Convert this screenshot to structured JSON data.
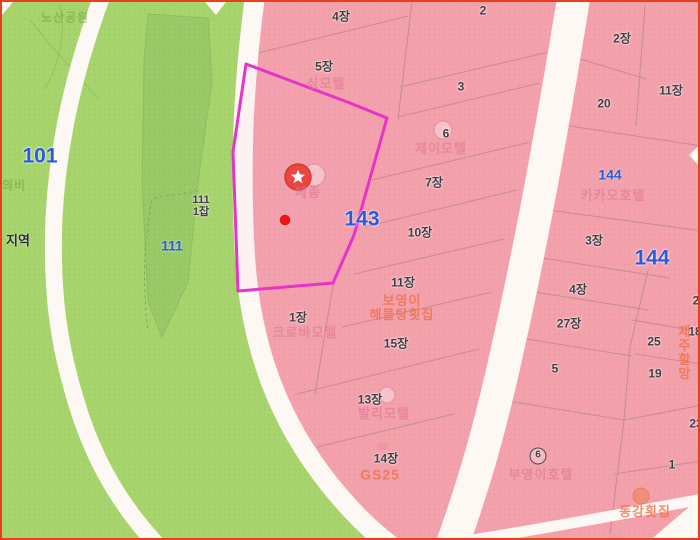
{
  "map": {
    "description": "Korean cadastral parcel map with highlighted lot",
    "colors": {
      "parcel_pink": "#f3a2ac",
      "forest_green": "#a8d46e",
      "forest_dark_green": "#99c966",
      "road_white": "#fdf8f4",
      "parcel_line": "#bf8a92",
      "highlight_magenta": "#e633c8",
      "zone_blue": "#2b59d8",
      "poi_orange": "#ee6e4a",
      "business_pink": "#df7392",
      "marker_red": "#e8463e",
      "frame_red": "#e8401c"
    },
    "labels": {
      "zones": [
        {
          "text": "101"
        },
        {
          "text": "111"
        },
        {
          "text": "143"
        },
        {
          "text": "144"
        },
        {
          "text": "144"
        }
      ],
      "parcels": [
        {
          "text": "4장"
        },
        {
          "text": "2"
        },
        {
          "text": "5장"
        },
        {
          "text": "3"
        },
        {
          "text": "6"
        },
        {
          "text": "2장"
        },
        {
          "text": "20"
        },
        {
          "text": "11장"
        },
        {
          "text": "7장"
        },
        {
          "text": "10장"
        },
        {
          "text": "11장"
        },
        {
          "text": "111\n1잡"
        },
        {
          "text": "1장"
        },
        {
          "text": "15장"
        },
        {
          "text": "13장"
        },
        {
          "text": "14장"
        },
        {
          "text": "3장"
        },
        {
          "text": "4장"
        },
        {
          "text": "27장"
        },
        {
          "text": "25"
        },
        {
          "text": "5"
        },
        {
          "text": "19"
        },
        {
          "text": "23"
        },
        {
          "text": "1"
        },
        {
          "text": "2"
        },
        {
          "text": "18"
        },
        {
          "text": "6"
        }
      ],
      "businesses": [
        {
          "text": "싱모텔"
        },
        {
          "text": "제이모텔"
        },
        {
          "text": "메종"
        },
        {
          "text": "카카오호텔"
        },
        {
          "text": "크로바모텔"
        },
        {
          "text": "발리모텔"
        },
        {
          "text": "부영이호텔"
        }
      ],
      "pois": [
        {
          "text": "보영이\n해물탕횟집"
        },
        {
          "text": "GS25"
        },
        {
          "text": "동강횟집"
        },
        {
          "text": "제주할망"
        }
      ],
      "terrain": [
        {
          "text": "노산공원"
        },
        {
          "text": "의비"
        },
        {
          "text": "지역"
        }
      ]
    }
  }
}
